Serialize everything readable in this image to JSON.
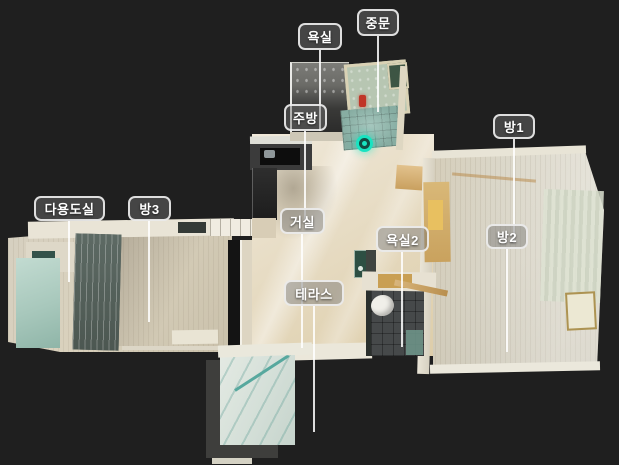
{
  "scene": {
    "description": "3D dollhouse top-down floor plan of an apartment",
    "background_color": "#1f1f1f"
  },
  "room_labels": [
    {
      "id": "bathroom",
      "text": "욕실"
    },
    {
      "id": "entry-door",
      "text": "중문"
    },
    {
      "id": "kitchen",
      "text": "주방"
    },
    {
      "id": "room1",
      "text": "방1"
    },
    {
      "id": "utility-room",
      "text": "다용도실"
    },
    {
      "id": "room3",
      "text": "방3"
    },
    {
      "id": "living-room",
      "text": "거실"
    },
    {
      "id": "bathroom2",
      "text": "욕실2"
    },
    {
      "id": "room2",
      "text": "방2"
    },
    {
      "id": "terrace",
      "text": "테라스"
    }
  ],
  "label_style": {
    "background": "rgba(115,115,115,0.45)",
    "border_color": "rgba(240,240,240,0.9)",
    "text_color": "#ffffff",
    "line_color": "rgba(255,255,255,0.85)"
  },
  "viewpoint_marker": {
    "color": "#19e3c1"
  }
}
